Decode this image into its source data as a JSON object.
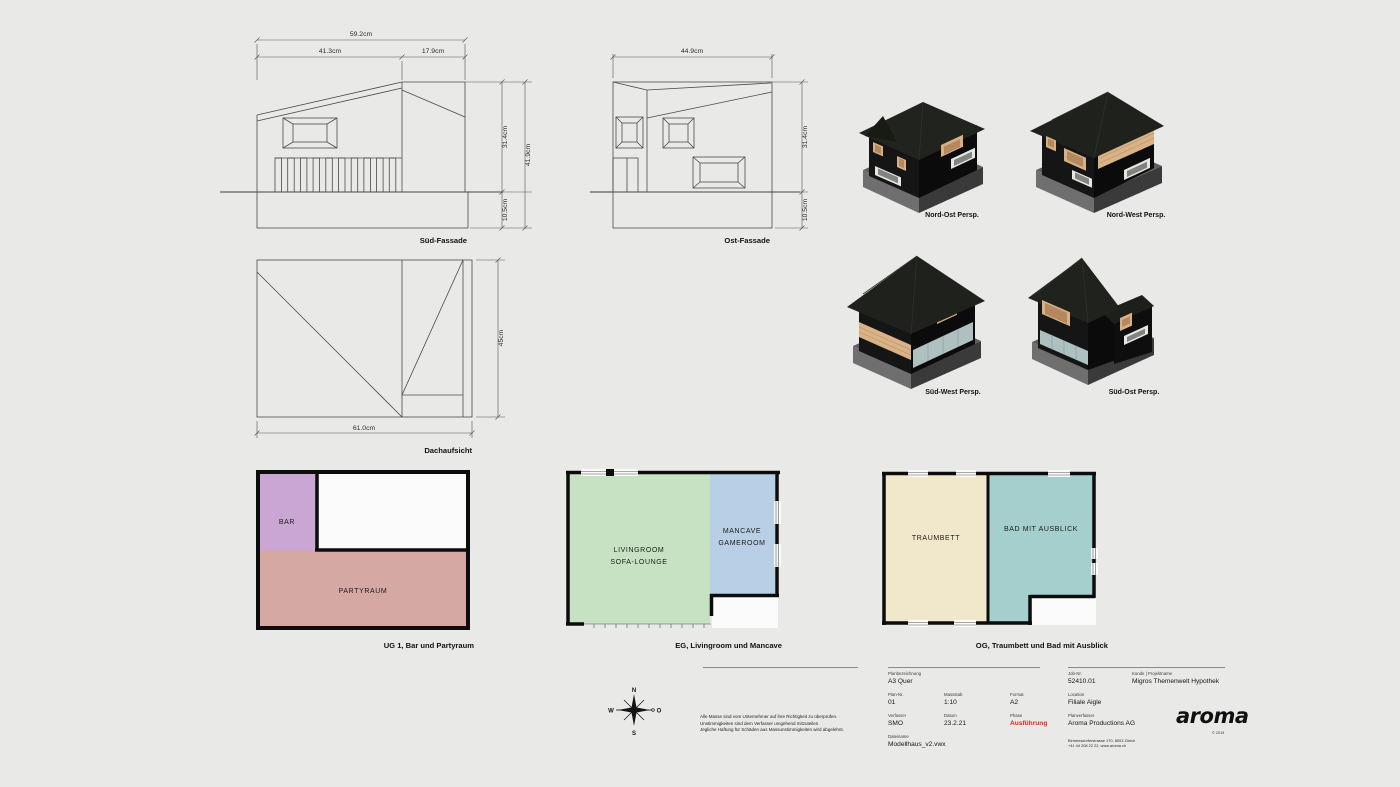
{
  "sheet": {
    "background": "#e9e9e7"
  },
  "elevations": {
    "sued": {
      "label": "Süd-Fassade",
      "dim_total": "59.2cm",
      "dim_left": "41.3cm",
      "dim_right": "17.9cm",
      "dim_wall": "31.4cm",
      "dim_full": "41.9cm",
      "dim_base": "10.5cm"
    },
    "ost": {
      "label": "Ost-Fassade",
      "dim_width": "44.9cm",
      "dim_wall": "31.4cm",
      "dim_base": "10.5cm"
    },
    "dach": {
      "label": "Dachaufsicht",
      "dim_width": "61.0cm",
      "dim_height": "45cm"
    }
  },
  "perspectives": [
    {
      "label": "Nord-Ost Persp."
    },
    {
      "label": "Nord-West Persp."
    },
    {
      "label": "Süd-West Persp."
    },
    {
      "label": "Süd-Ost Persp."
    }
  ],
  "floorplans": [
    {
      "label": "UG 1, Bar und Partyraum",
      "room1": "BAR",
      "room2": "PARTYRAUM"
    },
    {
      "label": "EG, Livingroom und Mancave",
      "room1_line1": "LIVINGROOM",
      "room1_line2": "SOFA-LOUNGE",
      "room2_line1": "MANCAVE",
      "room2_line2": "GAMEROOM"
    },
    {
      "label": "OG, Traumbett und Bad mit Ausblick",
      "room1": "TRAUMBETT",
      "room2": "BAD MIT AUSBLICK"
    }
  ],
  "compass": {
    "north": "N",
    "south": "S",
    "west": "W",
    "east": "O"
  },
  "disclaimer": {
    "line1": "Alle Masse sind vom Unternehmer auf ihre Richtigkeit zu überprüfen.",
    "line2": "Unstimmigkeiten sind dem Verfasser umgehend mitzuteilen.",
    "line3": "Jegliche Haftung für Schäden aus Massunstimmigkeiten wird abgelehnt."
  },
  "titleblock": {
    "plan_designation_label": "Planbezeichnung",
    "plan_designation": "A3 Quer",
    "plan_nr_label": "Plan-Nr.",
    "plan_nr": "01",
    "massstab_label": "Massstab",
    "massstab": "1:10",
    "format_label": "Format",
    "format": "A2",
    "verfasser_label": "Verfasser",
    "verfasser": "SMO",
    "datum_label": "Datum",
    "datum": "23.2.21",
    "phase_label": "Phase",
    "phase": "Ausführung",
    "phase_color": "#e8271c",
    "dateiname_label": "Dateiname",
    "dateiname": "Modellhaus_v2.vwx",
    "job_nr_label": "Job-Nr.",
    "job_nr": "52410.01",
    "kunde_label": "Kunde | Projektname",
    "kunde": "Migros Themenwelt Hypothek",
    "location_label": "Location",
    "location": "Filiale Aigle",
    "planverfasser_label": "Planverfasser",
    "planverfasser": "Aroma Productions AG",
    "address_line1": "Birmensdorferstrasse 170, 8003 Zürich",
    "address_line2": "+41 44 208 22 22, www.aroma.ch",
    "logo": "aroma",
    "logo_copyright": "© 2019"
  },
  "colors": {
    "background": "#e9e9e7",
    "phase_red": "#e8271c",
    "bar_purple": "#c9a6d3",
    "partyraum_rose": "#d5a8a4",
    "livingroom_green": "#c7e2c3",
    "mancave_blue": "#b9cfe6",
    "traumbett_cream": "#f1e7cb",
    "bad_teal": "#a5cfcd",
    "house_black": "#151515",
    "roof_dark": "#20231e",
    "plinth_grey": "#5d5d5d",
    "wood_tan": "#d8b084",
    "glass_blue": "#aec0c0"
  }
}
